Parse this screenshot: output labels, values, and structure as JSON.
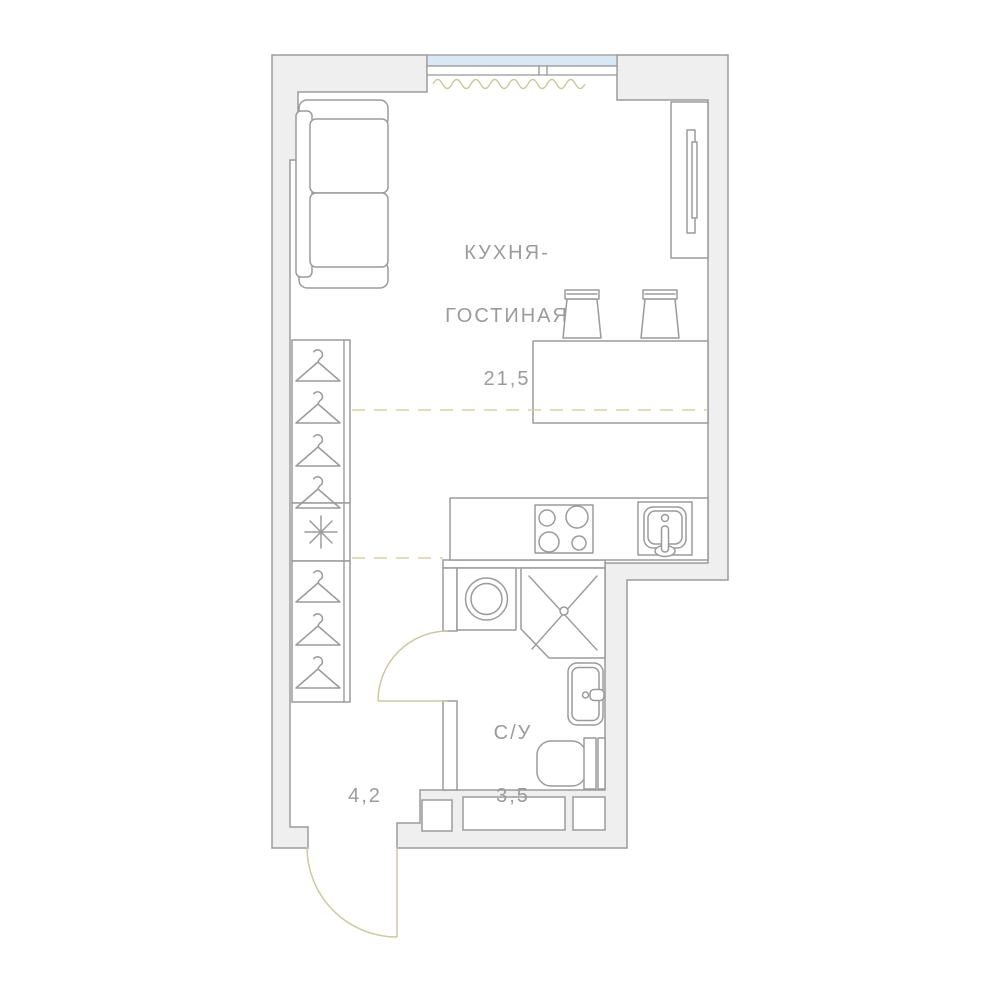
{
  "plan": {
    "rooms": [
      {
        "id": "kitchen-living-room",
        "label_line1": "КУХНЯ-",
        "label_line2": "ГОСТИНАЯ",
        "area": "21,5"
      },
      {
        "id": "bathroom",
        "label": "С/У",
        "area": "3,5"
      },
      {
        "id": "hallway",
        "area": "4,2"
      }
    ],
    "fixtures": [
      "sofa",
      "tv-console",
      "tv-panel",
      "window",
      "curtain",
      "bar-counter",
      "bar-stool",
      "wardrobe",
      "hanger-icon",
      "conditioner-asterisk-icon",
      "kitchen-counter",
      "stove",
      "kitchen-sink",
      "washing-machine",
      "shower",
      "bathroom-sink",
      "toilet",
      "door-swing-arc",
      "vent-shaft",
      "zone-dashed-line"
    ],
    "colors": {
      "wall_fill": "#EFEFEF",
      "wall_outline": "#9B9B9B",
      "window_glass": "#D8E8F5",
      "door_swing": "#CCC8A0",
      "dashed_zone_line": "#D5D1A8",
      "label_text": "#9B9B9B",
      "background": "#FFFFFF"
    }
  }
}
